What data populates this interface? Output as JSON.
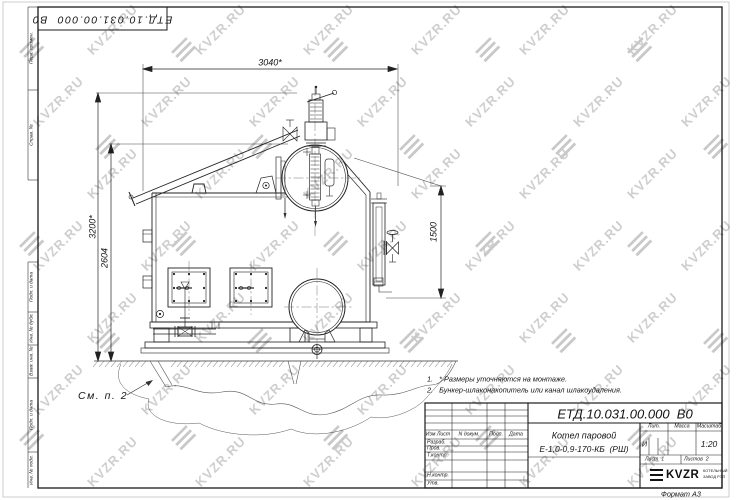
{
  "corner_stamp": {
    "designation": "ЕТД.10.031.00.000  В0"
  },
  "watermark": {
    "text": "KVZR.RU",
    "text_color": "#c6c6c6",
    "logo_color": "#c0c0c0"
  },
  "margin_columns": {
    "first_use": "Перв. примен.",
    "ref_number": "Справ. №",
    "sign_date_1": "Подп. и дата",
    "inv_dup": "Инв. № дубл.",
    "repl_inv": "Взам. инв. №",
    "sign_date_2": "Подп. и дата",
    "inv_orig": "Инв. № подл."
  },
  "drawing": {
    "callout": "См. п. 2",
    "notes": [
      "1.   * Размеры уточняются на монтаже.",
      "2.   Бункер-шлаконакопитель или канал шлакоудаления."
    ],
    "dimensions": {
      "width_top": "3040*",
      "height_overall": "3200*",
      "height_drum": "2604",
      "height_rear": "1500"
    }
  },
  "title_block": {
    "designation": "ЕТД.10.031.00.000  В0",
    "columns": {
      "change_sheet": "Изм Лист",
      "doc_no": "N докум.",
      "sign": "Подп.",
      "date": "Дата"
    },
    "rows": {
      "developed": "Разраб.",
      "checked": "Пров.",
      "t_control": "Т.контр.",
      "n_control": "Н.контр.",
      "approved": "Утв."
    },
    "product": {
      "line1": "Котел паровой",
      "line2": "Е-1,0-0,9-170-КБ  (РШ)"
    },
    "lit": {
      "header": "Лит.",
      "value": "И"
    },
    "mass": {
      "header": "Масса",
      "value": ""
    },
    "scale": {
      "header": "Масштаб",
      "value": "1:20"
    },
    "sheet": {
      "label": "Лист",
      "value": "1"
    },
    "sheets": {
      "label": "Листов",
      "value": "2"
    },
    "company": {
      "logo": "KVZR",
      "caption1": "КОТЕЛЬНЫЙ",
      "caption2": "ЗАВОД РЭП"
    },
    "format": "Формат А3"
  }
}
